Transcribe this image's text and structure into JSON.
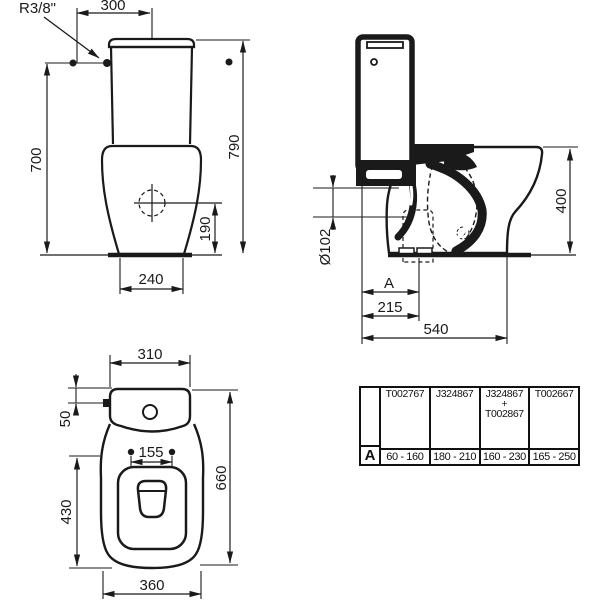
{
  "drawing": {
    "front_view": {
      "supply_thread_label": "R3/8\"",
      "dim_supply_to_center": "300",
      "dim_supply_height": "700",
      "dim_total_height": "790",
      "dim_outlet_center_height": "190",
      "dim_foot_width": "240"
    },
    "side_view": {
      "dim_outlet_diameter": "Ø102",
      "dim_bowl_height": "400",
      "dim_adjustable_label": "A",
      "dim_outlet_center_distance": "215",
      "dim_total_depth": "540"
    },
    "top_view": {
      "dim_cistern_width": "310",
      "dim_inlet_offset": "50",
      "dim_seat_hole_centers": "155",
      "dim_seat_length": "430",
      "dim_total_depth": "660",
      "dim_bowl_width": "360"
    }
  },
  "accessories_table": {
    "row_label": "A",
    "columns": [
      {
        "code": "T002767",
        "range": "60 - 160"
      },
      {
        "code": "J324867",
        "range": "180 - 210"
      },
      {
        "code": "J324867",
        "plus": "+",
        "code2": "T002867",
        "range": "160 - 230"
      },
      {
        "code": "T002667",
        "range": "165 - 250"
      }
    ]
  },
  "colors": {
    "line": "#1a1a1a",
    "background": "#ffffff",
    "icon_gray": "#8a8a8a"
  }
}
